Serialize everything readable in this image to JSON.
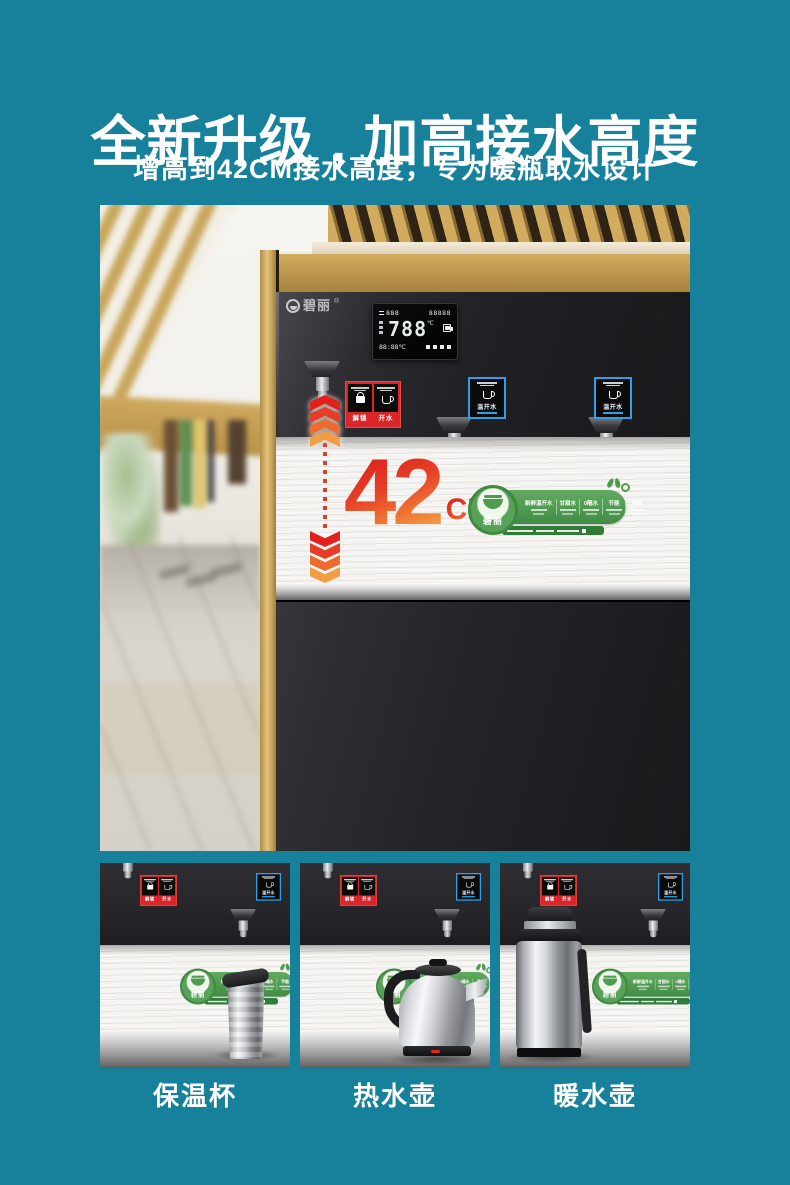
{
  "header": {
    "title": "全新升级 , 加高接水高度",
    "subtitle": "增高到42CM接水高度，专为暖瓶取水设计"
  },
  "hero": {
    "brand": "碧丽",
    "brand_reg": "®",
    "display": {
      "row1_left": "888",
      "row1_right": "88888",
      "main": "788",
      "main_unit": "℃",
      "row3_left": "88:88℃"
    },
    "height_callout": {
      "value": "42",
      "unit": "CM"
    },
    "tap_panels": {
      "red": {
        "left_label": "解锁",
        "right_label": "开水"
      },
      "blue_label": "温开水"
    },
    "badge": {
      "brand": "碧丽",
      "features": [
        "新鲜温开水",
        "甘甜水",
        "0隔水",
        "节能",
        "环保"
      ]
    }
  },
  "gallery": {
    "items": [
      {
        "label": "保温杯"
      },
      {
        "label": "热水壶"
      },
      {
        "label": "暖水壶"
      }
    ]
  },
  "colors": {
    "background": "#17819c",
    "accent_red": "#e0342b",
    "accent_orange": "#f49a3c",
    "badge_green": "#4f9b50",
    "tap_red": "#d8262a",
    "tap_blue": "#2fa0e8"
  }
}
